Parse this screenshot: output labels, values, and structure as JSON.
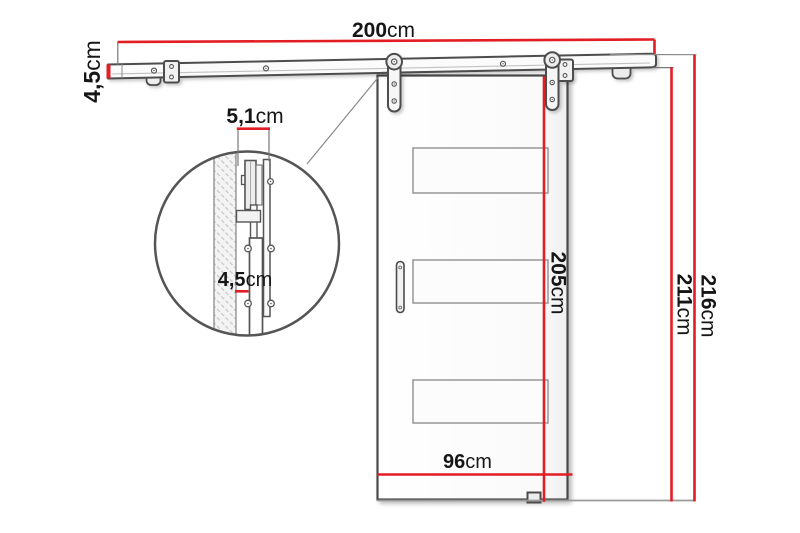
{
  "diagram": {
    "type": "sliding-barn-door-dimension-diagram",
    "unit_label": "cm",
    "dims": {
      "rail_length": "200",
      "rail_height": "4,5",
      "hardware_depth": "5,1",
      "detail_thickness": "4,5",
      "door_height": "205",
      "under_rail_height": "211",
      "total_height": "216",
      "door_width": "96"
    },
    "colors": {
      "dimension_red": "#e21d23",
      "outline_gray": "#4d4d4d",
      "extension_gray": "#808080",
      "text_black": "#161616"
    }
  }
}
